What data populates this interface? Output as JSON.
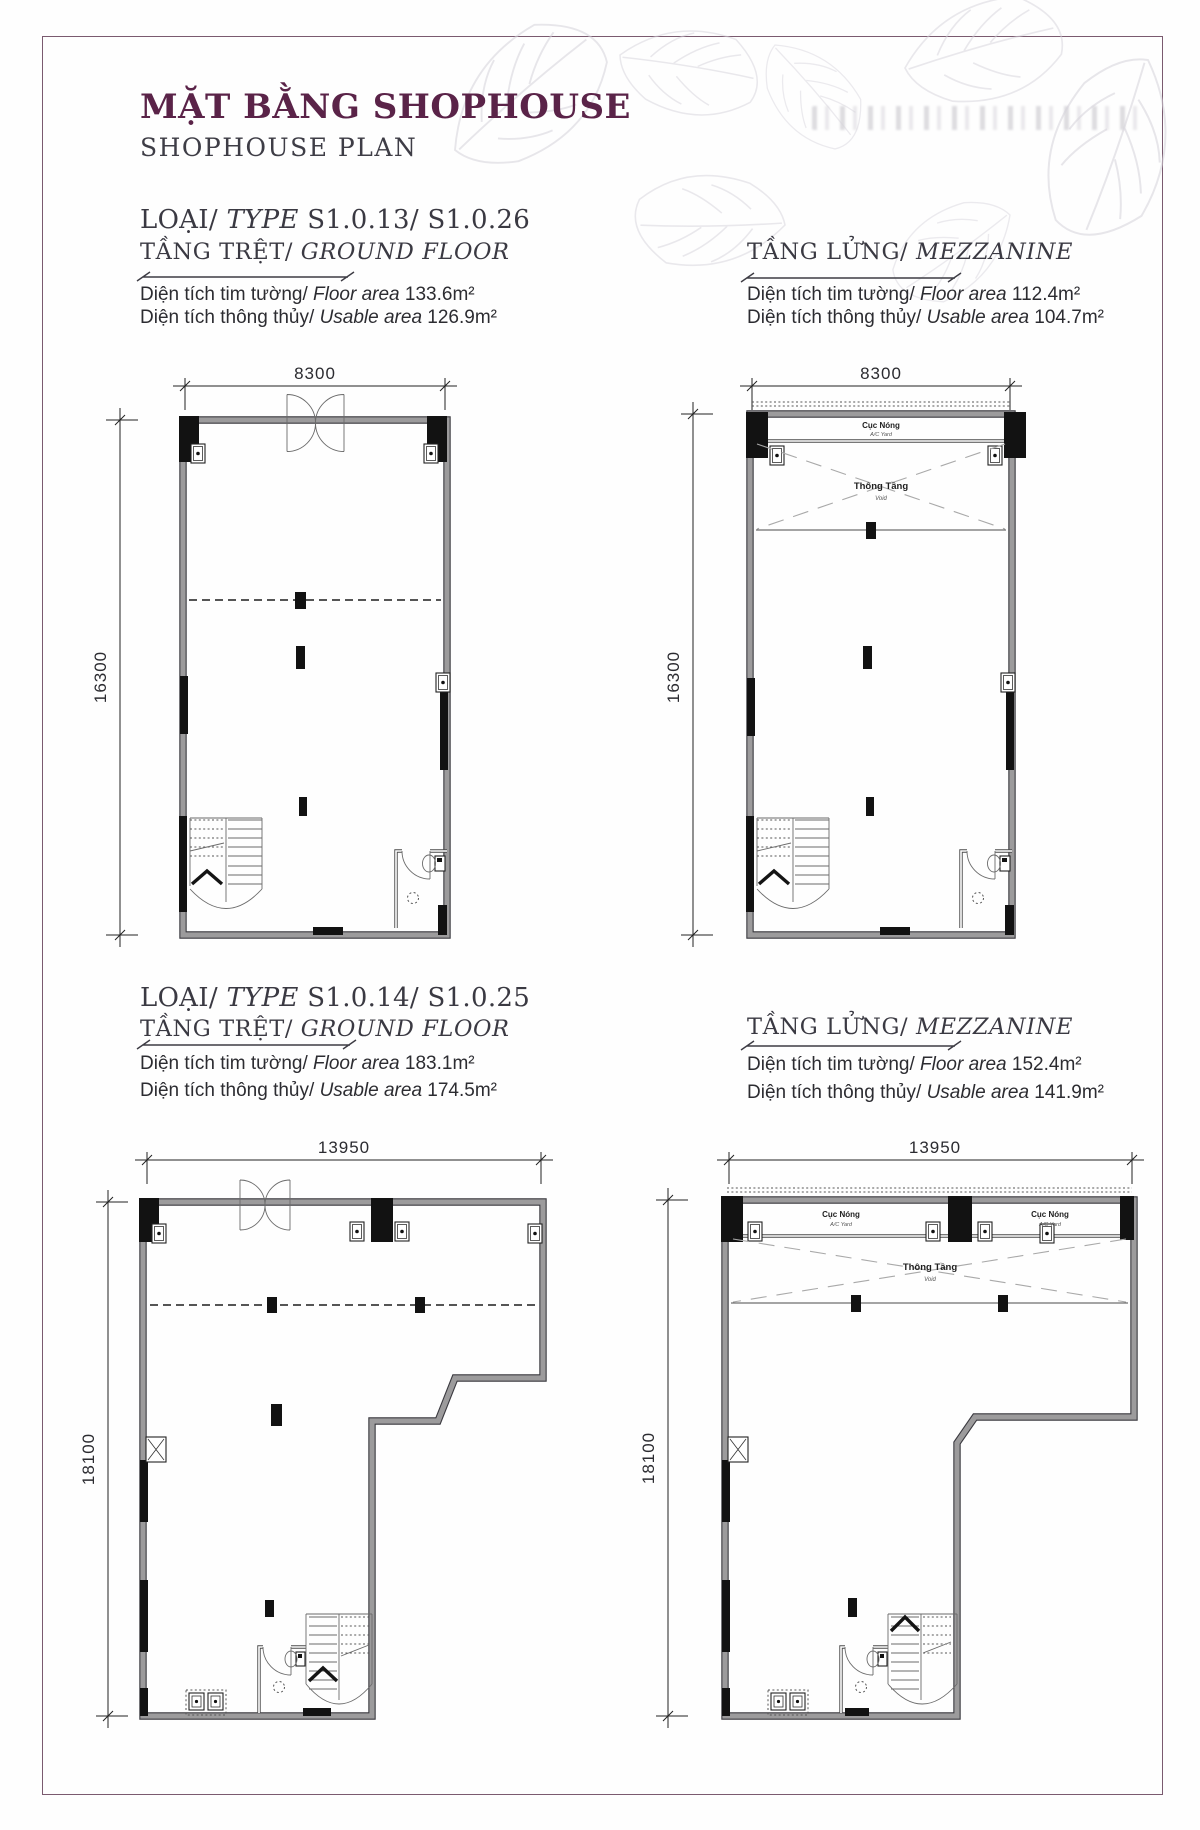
{
  "header": {
    "title": "MẶT BẰNG SHOPHOUSE",
    "subtitle": "SHOPHOUSE PLAN"
  },
  "sections": [
    {
      "type_vi": "LOẠI/",
      "type_en": "TYPE",
      "type_codes": "S1.0.13/ S1.0.26",
      "ground": {
        "floor_vi": "TẦNG TRỆT/",
        "floor_en": "GROUND FLOOR",
        "area1_vi": "Diện tích tim tường/",
        "area1_en": "Floor area",
        "area1_val": "133.6m²",
        "area2_vi": "Diện tích thông thủy/",
        "area2_en": "Usable area",
        "area2_val": "126.9m²",
        "dim_w": "8300",
        "dim_h": "16300"
      },
      "mezzanine": {
        "floor_vi": "TẦNG LỬNG/",
        "floor_en": "MEZZANINE",
        "area1_vi": "Diện tích tim tường/",
        "area1_en": "Floor area",
        "area1_val": "112.4m²",
        "area2_vi": "Diện tích thông thủy/",
        "area2_en": "Usable area",
        "area2_val": "104.7m²",
        "dim_w": "8300",
        "dim_h": "16300",
        "ac_label": "Cục Nóng",
        "ac_sub": "A/C Yard",
        "void_label": "Thông Tầng",
        "void_sub": "Void"
      }
    },
    {
      "type_vi": "LOẠI/",
      "type_en": "TYPE",
      "type_codes": "S1.0.14/ S1.0.25",
      "ground": {
        "floor_vi": "TẦNG TRỆT/",
        "floor_en": "GROUND FLOOR",
        "area1_vi": "Diện tích tim tường/",
        "area1_en": "Floor area",
        "area1_val": "183.1m²",
        "area2_vi": "Diện tích thông thủy/",
        "area2_en": "Usable area",
        "area2_val": "174.5m²",
        "dim_w": "13950",
        "dim_h": "18100"
      },
      "mezzanine": {
        "floor_vi": "TẦNG LỬNG/",
        "floor_en": "MEZZANINE",
        "area1_vi": "Diện tích tim tường/",
        "area1_en": "Floor area",
        "area1_val": "152.4m²",
        "area2_vi": "Diện tích thông thủy/",
        "area2_en": "Usable area",
        "area2_val": "141.9m²",
        "dim_w": "13950",
        "dim_h": "18100",
        "ac_label": "Cục Nóng",
        "ac_sub": "A/C Yard",
        "void_label": "Thông Tầng",
        "void_sub": "Void"
      }
    }
  ]
}
